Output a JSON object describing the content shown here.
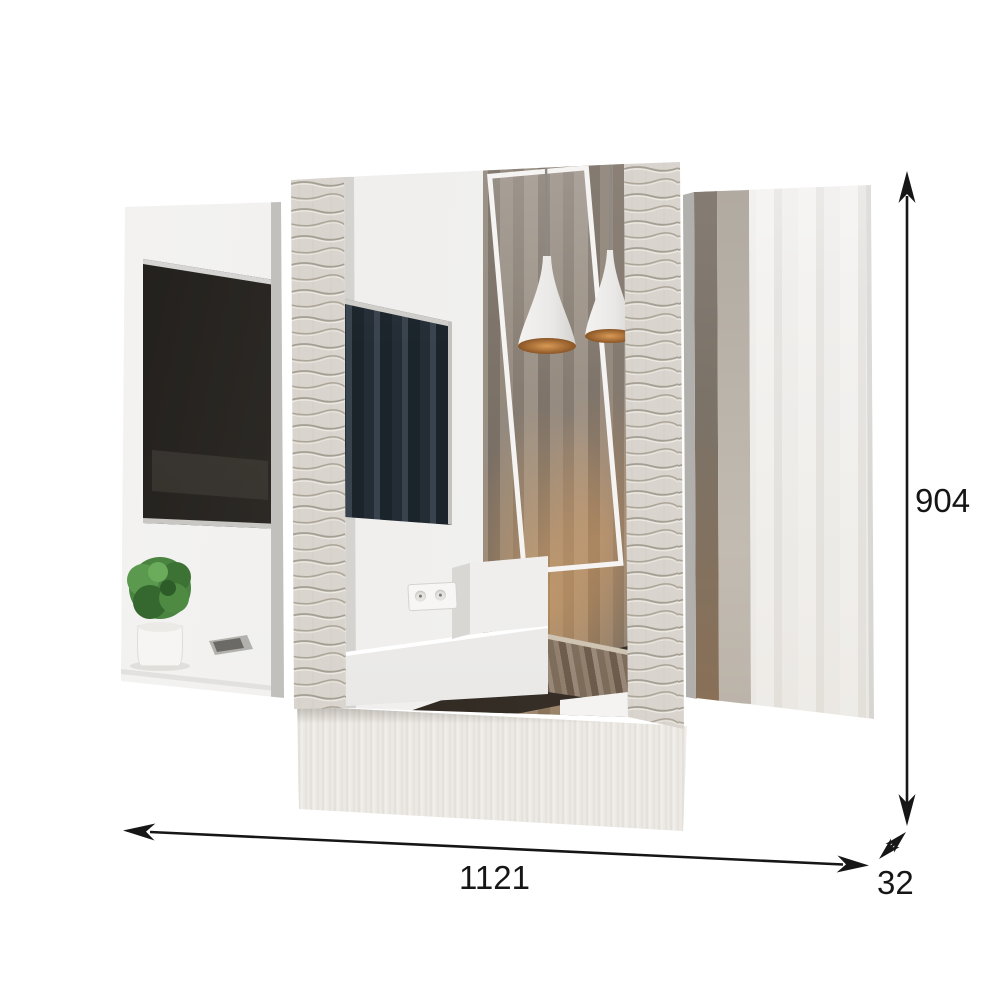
{
  "dims": {
    "width": "1121",
    "depth": "32",
    "height": "904"
  },
  "icons": {
    "height_arrow": "vertical-double-arrow",
    "width_arrow": "horizontal-double-arrow",
    "depth_arrow": "diagonal-double-arrow"
  },
  "colors": {
    "background": "#ffffff",
    "dimension_line": "#161616",
    "base_panel_wood": "#ece9e4",
    "decor_strip": "#d9d5ce",
    "tv_screen": "#20242b",
    "curtain_taupe": "#948a7e",
    "curtain_bronze": "#8a7158",
    "lamp_copper": "#b8793f",
    "plant_green": "#4a8440"
  }
}
